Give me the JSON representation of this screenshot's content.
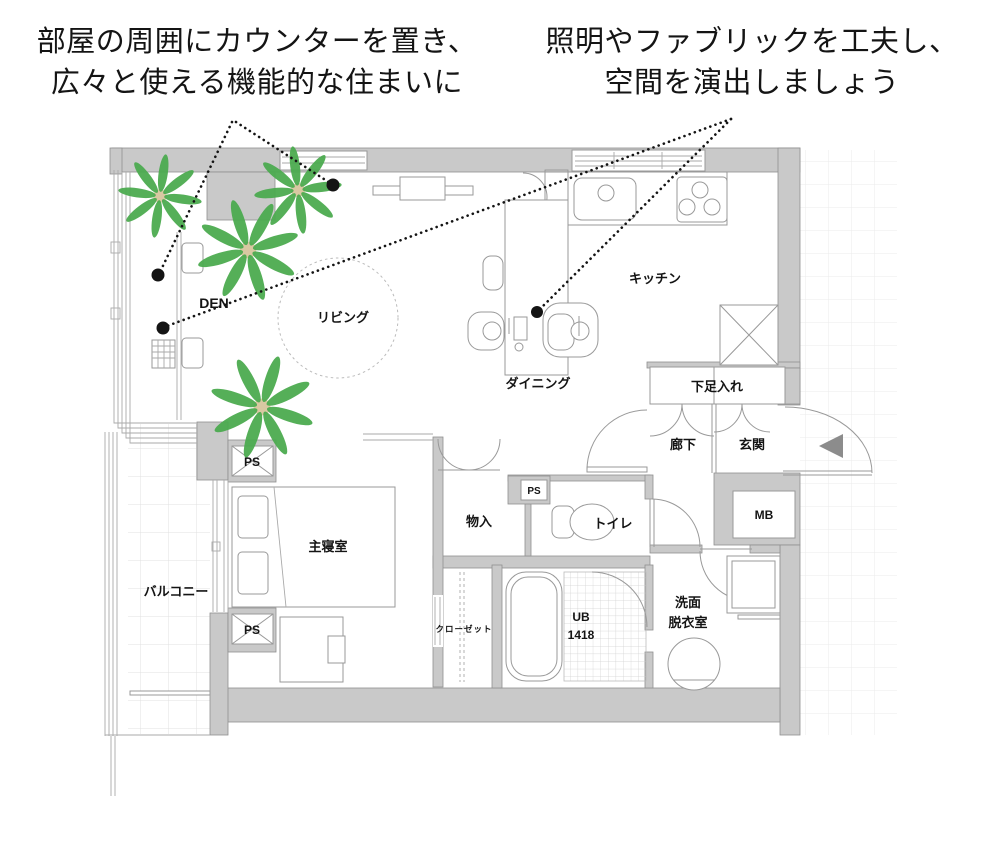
{
  "captions": {
    "left_line1": "部屋の周囲にカウンターを置き、",
    "left_line2": "広々と使える機能的な住まいに",
    "right_line1": "照明やファブリックを工夫し、",
    "right_line2": "空間を演出しましょう"
  },
  "labels": {
    "den": "DEN",
    "living": "リビング",
    "kitchen": "キッチン",
    "dining": "ダイニング",
    "shoe_storage": "下足入れ",
    "hallway": "廊下",
    "entrance": "玄関",
    "meter_box": "MB",
    "pipe_shaft": "PS",
    "storage": "物入",
    "toilet": "トイレ",
    "bedroom": "主寝室",
    "balcony": "バルコニー",
    "closet": "クローゼット",
    "unit_bath": "UB",
    "unit_bath_size": "1418",
    "washroom_line1": "洗面",
    "washroom_line2": "脱衣室"
  },
  "colors": {
    "wall": "#c9c9c9",
    "wall_outline": "#909090",
    "plant_leaf": "#4cab50",
    "plant_center": "#d9c8a2",
    "annotation": "#141414",
    "entrance_arrow": "#8c8c8c",
    "grid_line": "#ebebeb"
  }
}
